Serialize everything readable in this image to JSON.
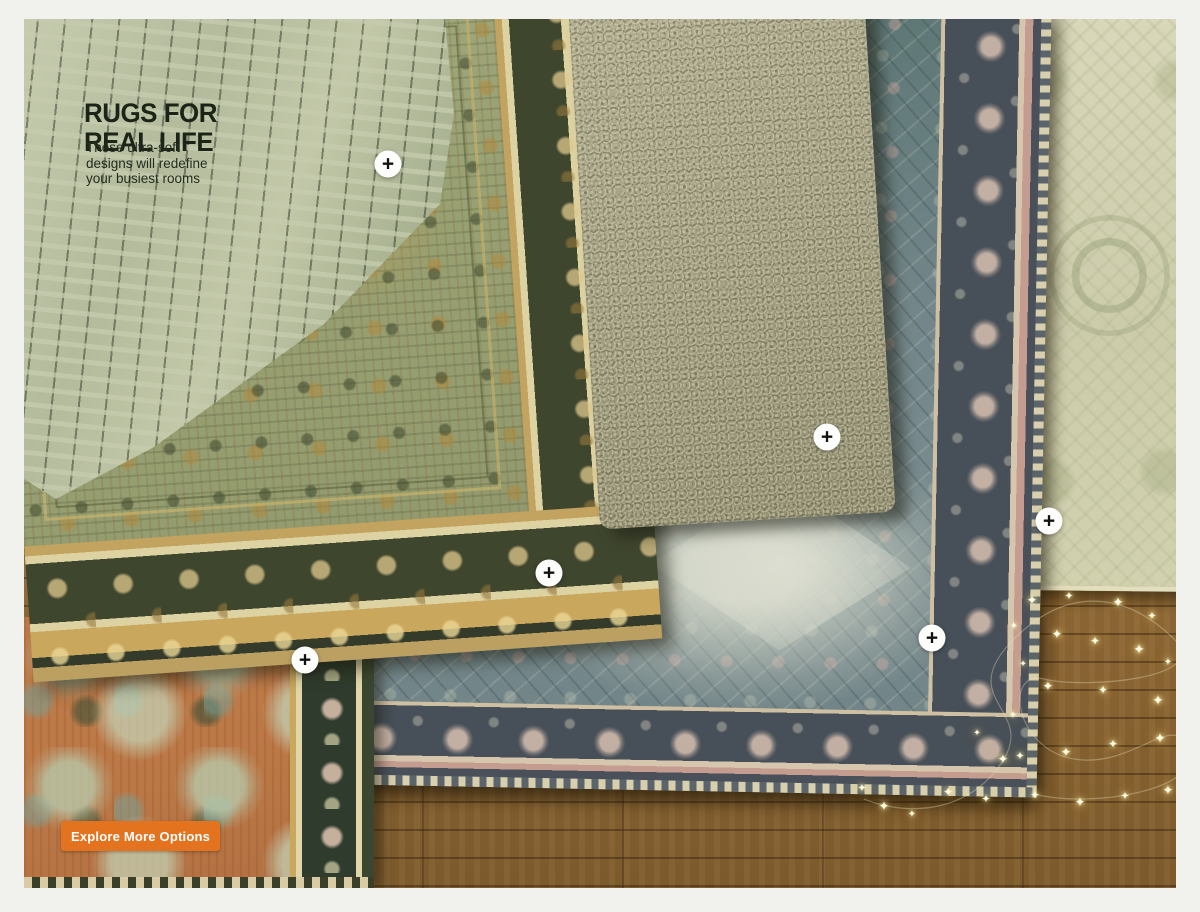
{
  "hero": {
    "title_line1": "RUGS FOR",
    "title_line2": "REAL LIFE",
    "subtitle_lines": [
      "These ultra-soft",
      "designs will redefine",
      "your busiest rooms"
    ]
  },
  "cta": {
    "label": "Explore More Options",
    "bg_color": "#e4731f",
    "text_color": "#ffffff"
  },
  "hotspots": {
    "symbol": "+",
    "items": [
      {
        "x": 364,
        "y": 145
      },
      {
        "x": 803,
        "y": 418
      },
      {
        "x": 525,
        "y": 554
      },
      {
        "x": 281,
        "y": 641
      },
      {
        "x": 908,
        "y": 619
      },
      {
        "x": 1025,
        "y": 502
      }
    ]
  },
  "lights": {
    "symbol": "✦",
    "items": [
      {
        "x": 838,
        "y": 770,
        "s": 11
      },
      {
        "x": 860,
        "y": 787,
        "s": 13
      },
      {
        "x": 888,
        "y": 796,
        "s": 10
      },
      {
        "x": 924,
        "y": 773,
        "s": 12
      },
      {
        "x": 962,
        "y": 781,
        "s": 11
      },
      {
        "x": 979,
        "y": 740,
        "s": 13
      },
      {
        "x": 989,
        "y": 697,
        "s": 10
      },
      {
        "x": 953,
        "y": 714,
        "s": 9
      },
      {
        "x": 1008,
        "y": 581,
        "s": 13
      },
      {
        "x": 1045,
        "y": 578,
        "s": 11
      },
      {
        "x": 1094,
        "y": 583,
        "s": 14
      },
      {
        "x": 1128,
        "y": 598,
        "s": 11
      },
      {
        "x": 990,
        "y": 608,
        "s": 10
      },
      {
        "x": 1033,
        "y": 615,
        "s": 13
      },
      {
        "x": 1071,
        "y": 622,
        "s": 12
      },
      {
        "x": 1115,
        "y": 630,
        "s": 14
      },
      {
        "x": 1144,
        "y": 644,
        "s": 10
      },
      {
        "x": 999,
        "y": 645,
        "s": 9
      },
      {
        "x": 1024,
        "y": 667,
        "s": 13
      },
      {
        "x": 1079,
        "y": 671,
        "s": 12
      },
      {
        "x": 1134,
        "y": 681,
        "s": 14
      },
      {
        "x": 996,
        "y": 738,
        "s": 11
      },
      {
        "x": 1042,
        "y": 733,
        "s": 13
      },
      {
        "x": 1089,
        "y": 725,
        "s": 12
      },
      {
        "x": 1136,
        "y": 719,
        "s": 14
      },
      {
        "x": 1011,
        "y": 776,
        "s": 12
      },
      {
        "x": 1056,
        "y": 783,
        "s": 13
      },
      {
        "x": 1101,
        "y": 778,
        "s": 11
      },
      {
        "x": 1144,
        "y": 771,
        "s": 13
      }
    ]
  },
  "colors": {
    "frame_bg": "#f1f1ee",
    "heading_text": "#1c2417",
    "cta_orange": "#e4731f",
    "wood_floor": "#8a6636",
    "rug_folded_back": "#b9c0a2",
    "rug_green_field": "#97a073",
    "rug_green_border": "#3f462e",
    "rug_shag": "#a3a083",
    "rug_blue_field": "#73868a",
    "rug_blue_border": "#474f58",
    "rug_cream": "#d1d1af",
    "rug_orange_field": "#bb7847",
    "rug_orange_border": "#2f3b2c",
    "fairy_light": "#fff3b0"
  }
}
